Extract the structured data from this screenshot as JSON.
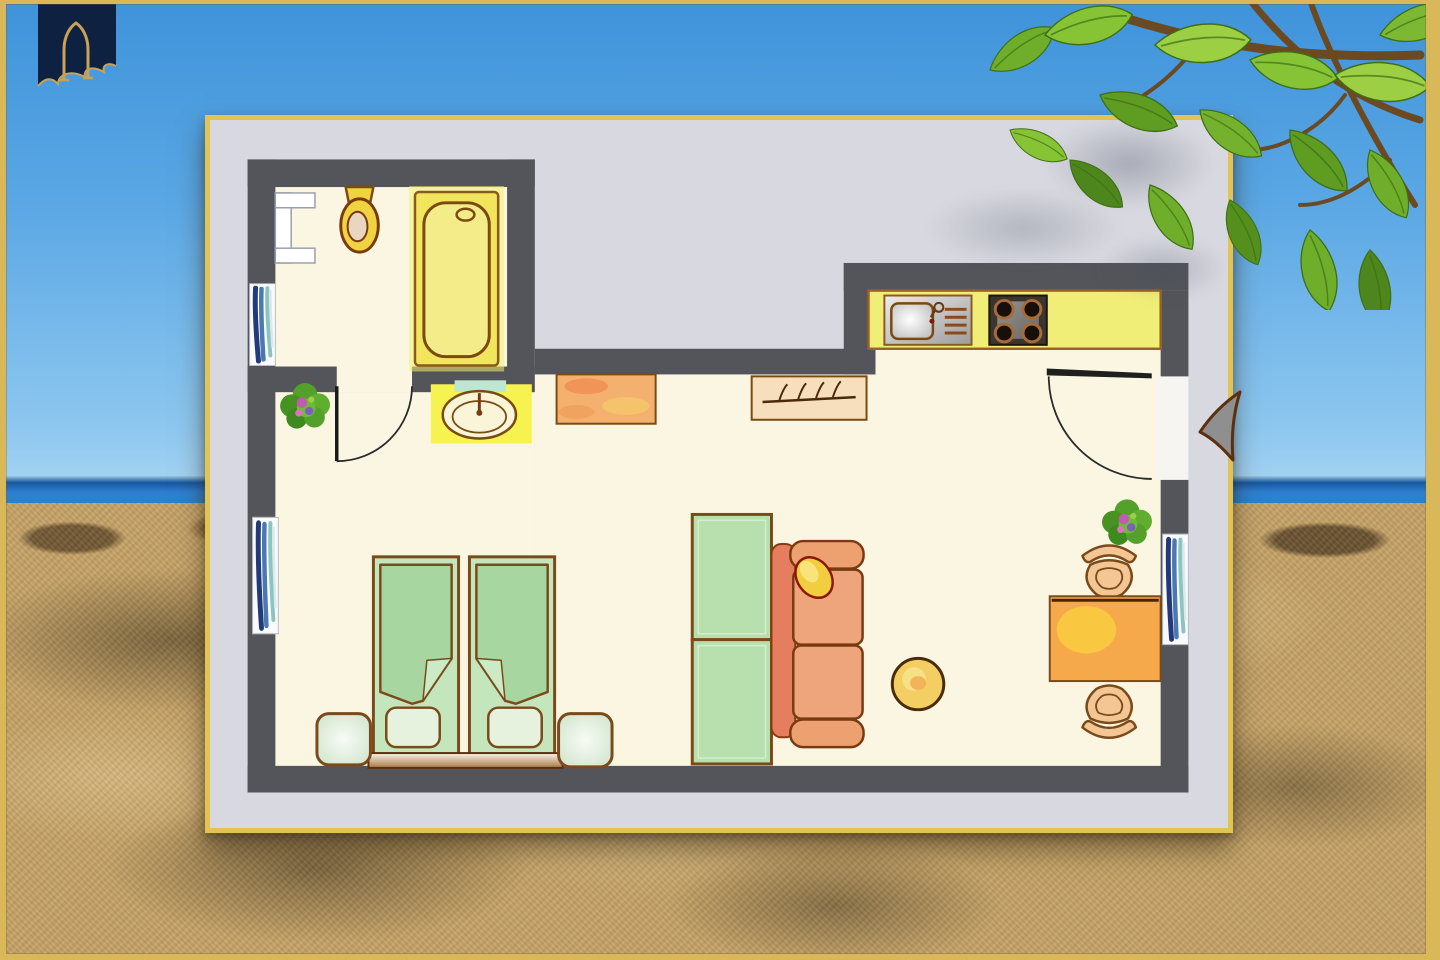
{
  "scene": {
    "description": "Hand-drawn studio apartment floor plan on a pale card propped on a sunny beach; blue sky and sea horizon behind, a green tree branch overhangs the top-right corner, navy arch pennant emblem hangs top-left",
    "sky_top": "#3f93da",
    "sky_horizon": "#aed8f3",
    "sea": "#2e7fd0",
    "sand": "#c3a166",
    "frame_gold": "#d9b85a",
    "emblem": {
      "navy": "#0e2140",
      "gold": "#c9a255"
    },
    "branch": {
      "wood": "#6b4a22",
      "leaf_greens": [
        "#4c861c",
        "#5f9c22",
        "#6fae2a",
        "#86c436",
        "#9ccf44"
      ]
    }
  },
  "colors": {
    "wall": "#54555a",
    "floor": "#fbf6e2",
    "card_bg": "#d7d8e0",
    "card_border": "#e2c452",
    "doorway_white": "#f6f5f1",
    "outline": "#7a4a1a",
    "bed_frame": "#c4e6bc",
    "blanket": "#a8d6a0",
    "blanket_fold": "#cdeac6",
    "pillow_bed": "#e6f2de",
    "wardrobe": "#b7e0ae",
    "sofa_body": "#efa57b",
    "sofa_back": "#e47e5e",
    "sofa_arm": "#eda070",
    "sofa_pillow": "#f2cd3e",
    "pouf": "#f3cf63",
    "table": "#f6a94b",
    "chair": "#f3c694",
    "counter": "#f1ee77",
    "stove_body": "#3a362f",
    "burner": "#16100a",
    "burner_rim": "#a86a38",
    "tub": "#f0e55c",
    "tub_inner": "#f4ec88",
    "basin_glow": "#f6f250",
    "toilet": "#f0d340",
    "ceramic": "#e8d6be",
    "dresser": "#f3b06e",
    "coatrack": "#f7debc",
    "door": "#1f1f1f",
    "arrow": "#8f8f8f",
    "window_navy": "#223a7a",
    "window_blue": "#4a78b0",
    "window_teal": "#8cc4c0",
    "radiator": "#ffffff",
    "plant_green": "#53a02a",
    "plant_blossom": "#c35ab2"
  },
  "floorplan": {
    "elements": [
      "outer-walls",
      "radiator",
      "toilet",
      "bathtub",
      "washbasin",
      "houseplant",
      "interior-door",
      "dresser",
      "coat-rack",
      "kitchen-counter",
      "kitchen-sink",
      "cooktop",
      "entrance-door",
      "entrance-arrow",
      "wardrobe",
      "sofa",
      "sofa-pillow",
      "pouf",
      "twin-beds",
      "bed-pillows",
      "nightstands",
      "headboard",
      "dining-table",
      "dining-chairs",
      "windows"
    ]
  }
}
